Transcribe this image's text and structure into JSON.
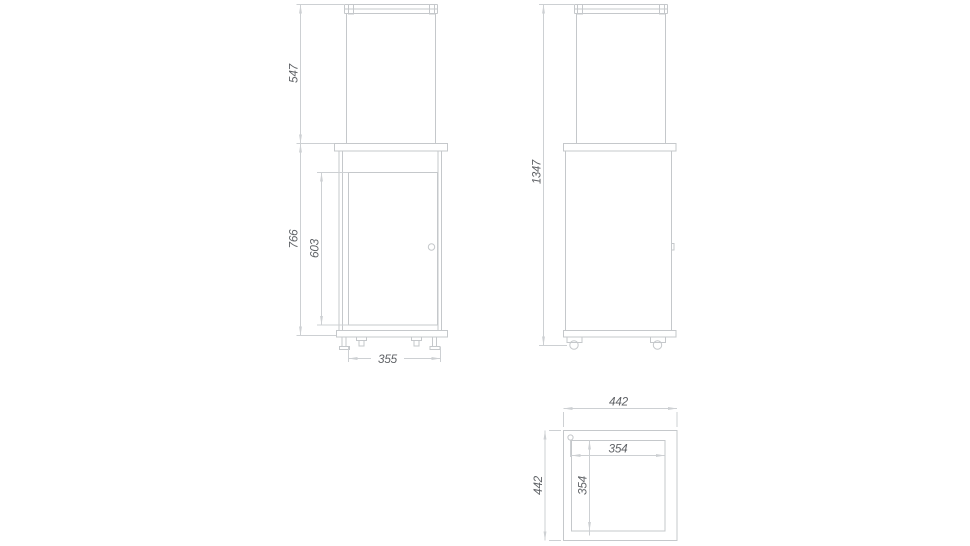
{
  "drawing": {
    "views": {
      "front": {
        "label": "front-view",
        "dims": {
          "glass_height": "547",
          "body_height": "766",
          "door_height": "603",
          "base_width": "355"
        }
      },
      "side": {
        "label": "side-view",
        "dims": {
          "total_height": "1347"
        }
      },
      "top": {
        "label": "top-view",
        "dims": {
          "outer_width": "442",
          "outer_depth": "442",
          "inner_width": "354",
          "inner_depth": "354"
        }
      }
    }
  },
  "colors": {
    "background": "#ffffff",
    "object_line": "#c5c8cb",
    "dimension_line": "#cdd0d3",
    "dimension_text": "#5f6266"
  }
}
